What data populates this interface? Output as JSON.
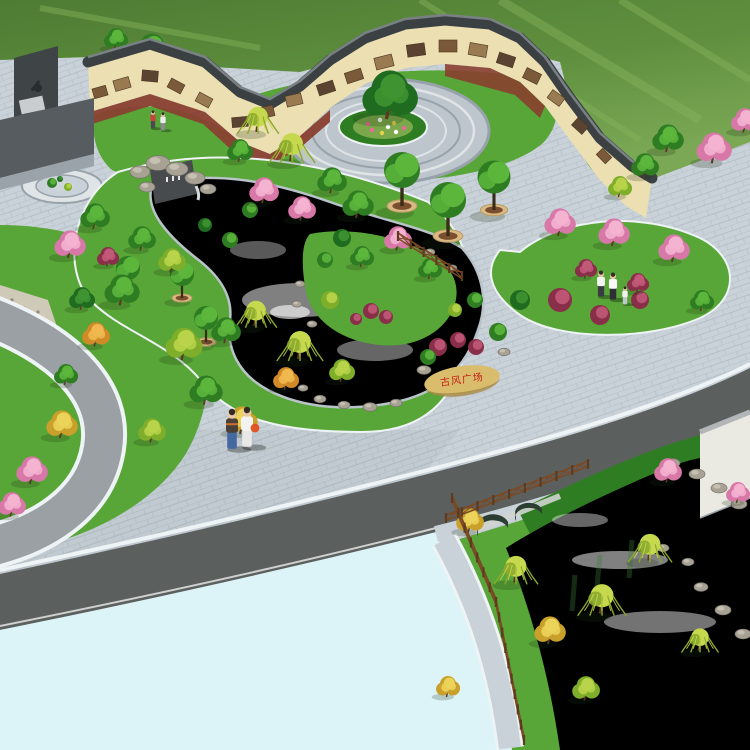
{
  "scene": {
    "type": "landscape-render",
    "title": "古风广场 bird's-eye landscape rendering",
    "stone_inscription": "古风广场",
    "colors": {
      "field": "#4e7c33",
      "field_mid": "#5f8f3e",
      "field_light": "#7aa855",
      "field_streak": "#86b35c",
      "pavement": "#c9d2d8",
      "pavement_joint": "#a9b4bc",
      "plaza_fill": "#bdc6cc",
      "plaza_ring": "#97a2aa",
      "plaza_light": "#dfe4e7",
      "wall_face": "#ecdfb2",
      "wall_shade": "#d0b987",
      "coping": "#3b4043",
      "coping_hi": "#7a8184",
      "mural_a": "#7a5a38",
      "mural_b": "#9a7a50",
      "mural_c": "#5a4330",
      "strip": "#8a4030",
      "monument": "#565c60",
      "monument_back": "#3f4447",
      "monument_step": "#9aa3a9",
      "monument_panel": "#c9cdcf",
      "lawn": "#58a637",
      "lawn_dark": "#2f7d22",
      "water_edge": "#b9c4c9",
      "water_deep": "#5d9a96",
      "water_mid": "#9ccad0",
      "water_light": "#e8f6f4",
      "stream_top": "#8fc4b8",
      "stream_low": "#a9d4de",
      "cyan_pool": "#dcf4f7",
      "road": "#5b605e",
      "road_left": "#9aa0a3",
      "curb": "#eef3f5",
      "wood": "#7a4a26",
      "wood_dark": "#5e3a1e",
      "rock": "#a8a295",
      "rock_dark": "#76716a",
      "pebble": "#cfc9b8",
      "stone": "#d9bd6d",
      "stone_dark": "#a8894a",
      "stone_text": "#c21f12",
      "planter_ring": "#d9ba84",
      "planter_soil": "#7a4e2e",
      "trunk": "#5a3a22",
      "building": "#eaeae2",
      "building_edge": "#b3b6b8",
      "skin": "#e8c8a8",
      "arch_dark": "#2c3e32",
      "arch_stone": "#cfd4cf",
      "shadow": "rgba(30,50,25,0.22)"
    },
    "palette": {
      "green": {
        "b": "#2f7d22",
        "h": "#5cb63c"
      },
      "darkgreen": {
        "b": "#1f6b1f",
        "h": "#3f9431"
      },
      "lime": {
        "b": "#7fae2a",
        "h": "#b9d44a"
      },
      "willow": {
        "b": "#8aa82e",
        "h": "#c6d94e"
      },
      "yellow": {
        "b": "#c9a02a",
        "h": "#ecd35a"
      },
      "orange": {
        "b": "#d08a28",
        "h": "#f0b84e"
      },
      "pink": {
        "b": "#d878a8",
        "h": "#f4b3d0"
      },
      "red": {
        "b": "#8a2f4a",
        "h": "#c05a78"
      }
    },
    "trees_back": [
      [
        "green",
        152,
        52,
        20
      ],
      [
        "green",
        116,
        40,
        13
      ]
    ],
    "trees": [
      [
        "willow",
        258,
        122,
        18
      ],
      [
        "willow",
        292,
        150,
        20
      ],
      [
        "green",
        240,
        152,
        14
      ],
      [
        "pink",
        264,
        192,
        16
      ],
      [
        "pink",
        302,
        210,
        15
      ],
      [
        "green",
        332,
        182,
        16
      ],
      [
        "green",
        358,
        206,
        17
      ],
      [
        "darkgreen",
        390,
        98,
        30
      ],
      [
        "green",
        95,
        218,
        16
      ],
      [
        "pink",
        70,
        246,
        17
      ],
      [
        "red",
        108,
        258,
        12
      ],
      [
        "green",
        142,
        240,
        15
      ],
      [
        "lime",
        172,
        262,
        15
      ],
      [
        "green",
        122,
        292,
        19
      ],
      [
        "darkgreen",
        82,
        300,
        14
      ],
      [
        "willow",
        256,
        316,
        18
      ],
      [
        "willow",
        300,
        348,
        20
      ],
      [
        "lime",
        342,
        372,
        14
      ],
      [
        "orange",
        286,
        380,
        14
      ],
      [
        "pink",
        398,
        240,
        15
      ],
      [
        "green",
        362,
        258,
        13
      ],
      [
        "green",
        430,
        270,
        13
      ],
      [
        "pink",
        560,
        224,
        17
      ],
      [
        "pink",
        614,
        234,
        17
      ],
      [
        "pink",
        674,
        250,
        17
      ],
      [
        "red",
        586,
        270,
        12
      ],
      [
        "red",
        638,
        284,
        12
      ],
      [
        "green",
        702,
        302,
        13
      ],
      [
        "pink",
        714,
        150,
        19
      ],
      [
        "pink",
        745,
        122,
        15
      ],
      [
        "green",
        668,
        140,
        17
      ],
      [
        "green",
        645,
        167,
        15
      ],
      [
        "lime",
        620,
        188,
        13
      ],
      [
        "lime",
        184,
        346,
        20
      ],
      [
        "green",
        226,
        332,
        16
      ],
      [
        "green",
        206,
        392,
        18
      ],
      [
        "yellow",
        242,
        422,
        17
      ],
      [
        "lime",
        152,
        432,
        15
      ],
      [
        "orange",
        96,
        336,
        15
      ],
      [
        "yellow",
        62,
        426,
        17
      ],
      [
        "pink",
        32,
        472,
        17
      ],
      [
        "pink",
        12,
        506,
        15
      ],
      [
        "green",
        66,
        376,
        13
      ],
      [
        "yellow",
        470,
        522,
        15
      ],
      [
        "willow",
        516,
        572,
        19
      ],
      [
        "yellow",
        550,
        632,
        17
      ],
      [
        "willow",
        602,
        602,
        21
      ],
      [
        "willow",
        650,
        550,
        19
      ],
      [
        "pink",
        668,
        472,
        15
      ],
      [
        "pink",
        738,
        494,
        13
      ],
      [
        "lime",
        586,
        690,
        15
      ],
      [
        "yellow",
        448,
        688,
        13
      ],
      [
        "willow",
        700,
        642,
        16
      ]
    ],
    "bushes": [
      [
        371,
        311,
        8,
        "red"
      ],
      [
        386,
        317,
        7,
        "red"
      ],
      [
        356,
        319,
        6,
        "red"
      ],
      [
        438,
        347,
        9,
        "red"
      ],
      [
        458,
        340,
        8,
        "red"
      ],
      [
        476,
        347,
        8,
        "red"
      ],
      [
        428,
        357,
        8,
        "green"
      ],
      [
        498,
        332,
        9,
        "green"
      ],
      [
        520,
        300,
        10,
        "darkgreen"
      ],
      [
        342,
        238,
        9,
        "darkgreen"
      ],
      [
        325,
        260,
        8,
        "green"
      ],
      [
        330,
        300,
        9,
        "lime"
      ],
      [
        560,
        300,
        12,
        "red"
      ],
      [
        600,
        315,
        10,
        "red"
      ],
      [
        640,
        300,
        9,
        "red"
      ],
      [
        230,
        240,
        8,
        "green"
      ],
      [
        205,
        225,
        7,
        "darkgreen"
      ],
      [
        250,
        210,
        8,
        "green"
      ],
      [
        455,
        310,
        7,
        "lime"
      ],
      [
        475,
        300,
        8,
        "green"
      ],
      [
        52,
        183,
        5,
        "green"
      ],
      [
        68,
        187,
        4,
        "lime"
      ],
      [
        60,
        179,
        3,
        "darkgreen"
      ]
    ],
    "planters": [
      [
        128,
        292,
        16
      ],
      [
        182,
        298,
        16
      ],
      [
        206,
        342,
        16
      ],
      [
        402,
        206,
        24
      ],
      [
        448,
        236,
        24
      ],
      [
        494,
        210,
        22
      ]
    ],
    "rocks": [
      [
        140,
        172,
        10
      ],
      [
        158,
        163,
        12
      ],
      [
        177,
        169,
        11
      ],
      [
        195,
        178,
        10
      ],
      [
        208,
        189,
        8
      ],
      [
        147,
        187,
        8
      ],
      [
        320,
        399,
        6
      ],
      [
        344,
        405,
        6
      ],
      [
        370,
        407,
        7
      ],
      [
        396,
        403,
        6
      ],
      [
        303,
        388,
        5
      ],
      [
        424,
        370,
        7
      ],
      [
        504,
        352,
        6
      ],
      [
        300,
        284,
        5
      ],
      [
        297,
        304,
        5
      ],
      [
        312,
        324,
        5
      ],
      [
        430,
        252,
        5
      ],
      [
        452,
        268,
        5
      ],
      [
        673,
        463,
        7
      ],
      [
        697,
        474,
        8
      ],
      [
        719,
        488,
        8
      ],
      [
        739,
        504,
        8
      ],
      [
        701,
        587,
        7
      ],
      [
        723,
        610,
        8
      ],
      [
        743,
        634,
        8
      ],
      [
        688,
        562,
        6
      ],
      [
        663,
        548,
        6
      ]
    ],
    "murals": [
      [
        100,
        92,
        14,
        10,
        -16,
        0
      ],
      [
        122,
        84,
        16,
        11,
        -16,
        1
      ],
      [
        150,
        76,
        16,
        11,
        5,
        2
      ],
      [
        176,
        86,
        15,
        10,
        28,
        0
      ],
      [
        204,
        100,
        15,
        10,
        28,
        1
      ],
      [
        240,
        122,
        16,
        10,
        -5,
        2
      ],
      [
        266,
        112,
        16,
        11,
        -13,
        0
      ],
      [
        294,
        100,
        16,
        11,
        -13,
        1
      ],
      [
        326,
        88,
        17,
        11,
        -18,
        2
      ],
      [
        354,
        76,
        17,
        11,
        -18,
        0
      ],
      [
        384,
        62,
        18,
        12,
        -14,
        1
      ],
      [
        416,
        50,
        18,
        12,
        -8,
        2
      ],
      [
        448,
        46,
        18,
        12,
        0,
        0
      ],
      [
        478,
        50,
        18,
        12,
        10,
        1
      ],
      [
        506,
        60,
        17,
        11,
        18,
        2
      ],
      [
        532,
        76,
        16,
        11,
        26,
        0
      ],
      [
        556,
        98,
        15,
        10,
        36,
        1
      ],
      [
        580,
        126,
        14,
        10,
        42,
        2
      ],
      [
        604,
        156,
        13,
        9,
        46,
        0
      ]
    ],
    "fences": [
      [
        398,
        240,
        462,
        280
      ],
      [
        446,
        522,
        588,
        468
      ],
      [
        452,
        502,
        496,
        606
      ],
      [
        496,
        606,
        524,
        744
      ]
    ],
    "people": [
      [
        232,
        448,
        40,
        "#4a4038",
        "#4468a0",
        null,
        "#d07030"
      ],
      [
        247,
        446,
        40,
        "#f2f2f0",
        "#e8e8e6",
        "#e05525",
        null
      ],
      [
        601,
        296,
        26,
        "#f4f4f2",
        "#3a3a42",
        null,
        null
      ],
      [
        613,
        299,
        27,
        "#f8f8f6",
        "#2e2e36",
        null,
        null
      ],
      [
        625,
        304,
        18,
        "#f2f2ee",
        "#c0c8cc",
        null,
        null
      ],
      [
        153,
        128,
        18,
        "#c04838",
        "#4a4a52",
        null,
        null
      ],
      [
        163,
        130,
        18,
        "#ececea",
        "#8a8a92",
        null,
        null
      ]
    ],
    "flowers": {
      "points": [
        [
          368,
          124
        ],
        [
          380,
          120
        ],
        [
          394,
          123
        ],
        [
          404,
          128
        ],
        [
          396,
          132
        ],
        [
          382,
          133
        ],
        [
          372,
          130
        ],
        [
          388,
          127
        ]
      ],
      "colors": [
        "#e86a9a",
        "#ffffff",
        "#e8d04a"
      ]
    }
  }
}
